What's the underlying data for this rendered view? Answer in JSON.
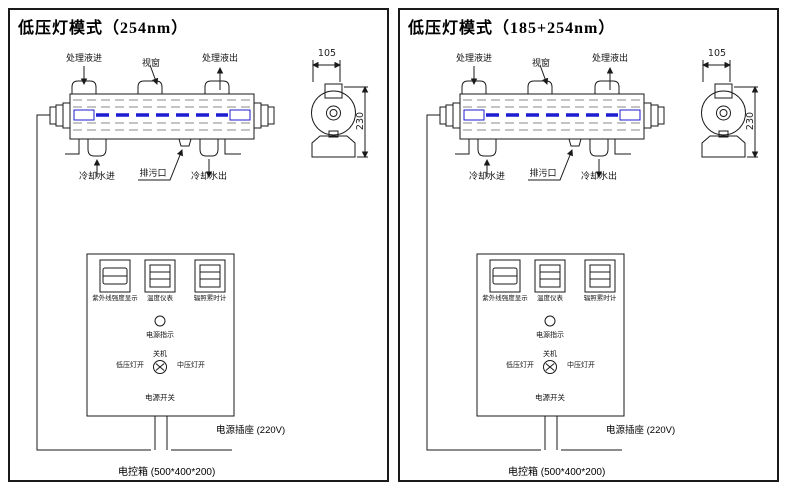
{
  "colors": {
    "line": "#1a1a1a",
    "lamp_blue": "#1c1cd0",
    "dash_gray": "#8a8a8a",
    "background": "#ffffff"
  },
  "panels": [
    {
      "title": "低压灯模式（254nm）",
      "chamber": {
        "inlet": "处理液进",
        "window": "视窗",
        "outlet": "处理液出",
        "cooling_in": "冷却水进",
        "drain": "排污口",
        "cooling_out": "冷却水出"
      },
      "side_view": {
        "width_mm": "105",
        "height_mm": "230"
      },
      "control_box": {
        "uv_intensity_meter": "紫外线强度显示",
        "temperature_meter": "温度仪表",
        "timer_meter": "辐照累时计",
        "power_indicator": "电源指示",
        "switch_off": "关机",
        "switch_low": "低压灯开",
        "switch_medium": "中压灯开",
        "power_switch": "电源开关"
      },
      "socket": "电源插座 (220V)",
      "enclosure": "电控箱 (500*400*200)"
    },
    {
      "title": "低压灯模式（185+254nm）",
      "chamber": {
        "inlet": "处理液进",
        "window": "视窗",
        "outlet": "处理液出",
        "cooling_in": "冷却水进",
        "drain": "排污口",
        "cooling_out": "冷却水出"
      },
      "side_view": {
        "width_mm": "105",
        "height_mm": "230"
      },
      "control_box": {
        "uv_intensity_meter": "紫外线强度显示",
        "temperature_meter": "温度仪表",
        "timer_meter": "辐照累时计",
        "power_indicator": "电源指示",
        "switch_off": "关机",
        "switch_low": "低压灯开",
        "switch_medium": "中压灯开",
        "power_switch": "电源开关"
      },
      "socket": "电源插座 (220V)",
      "enclosure": "电控箱 (500*400*200)"
    }
  ]
}
